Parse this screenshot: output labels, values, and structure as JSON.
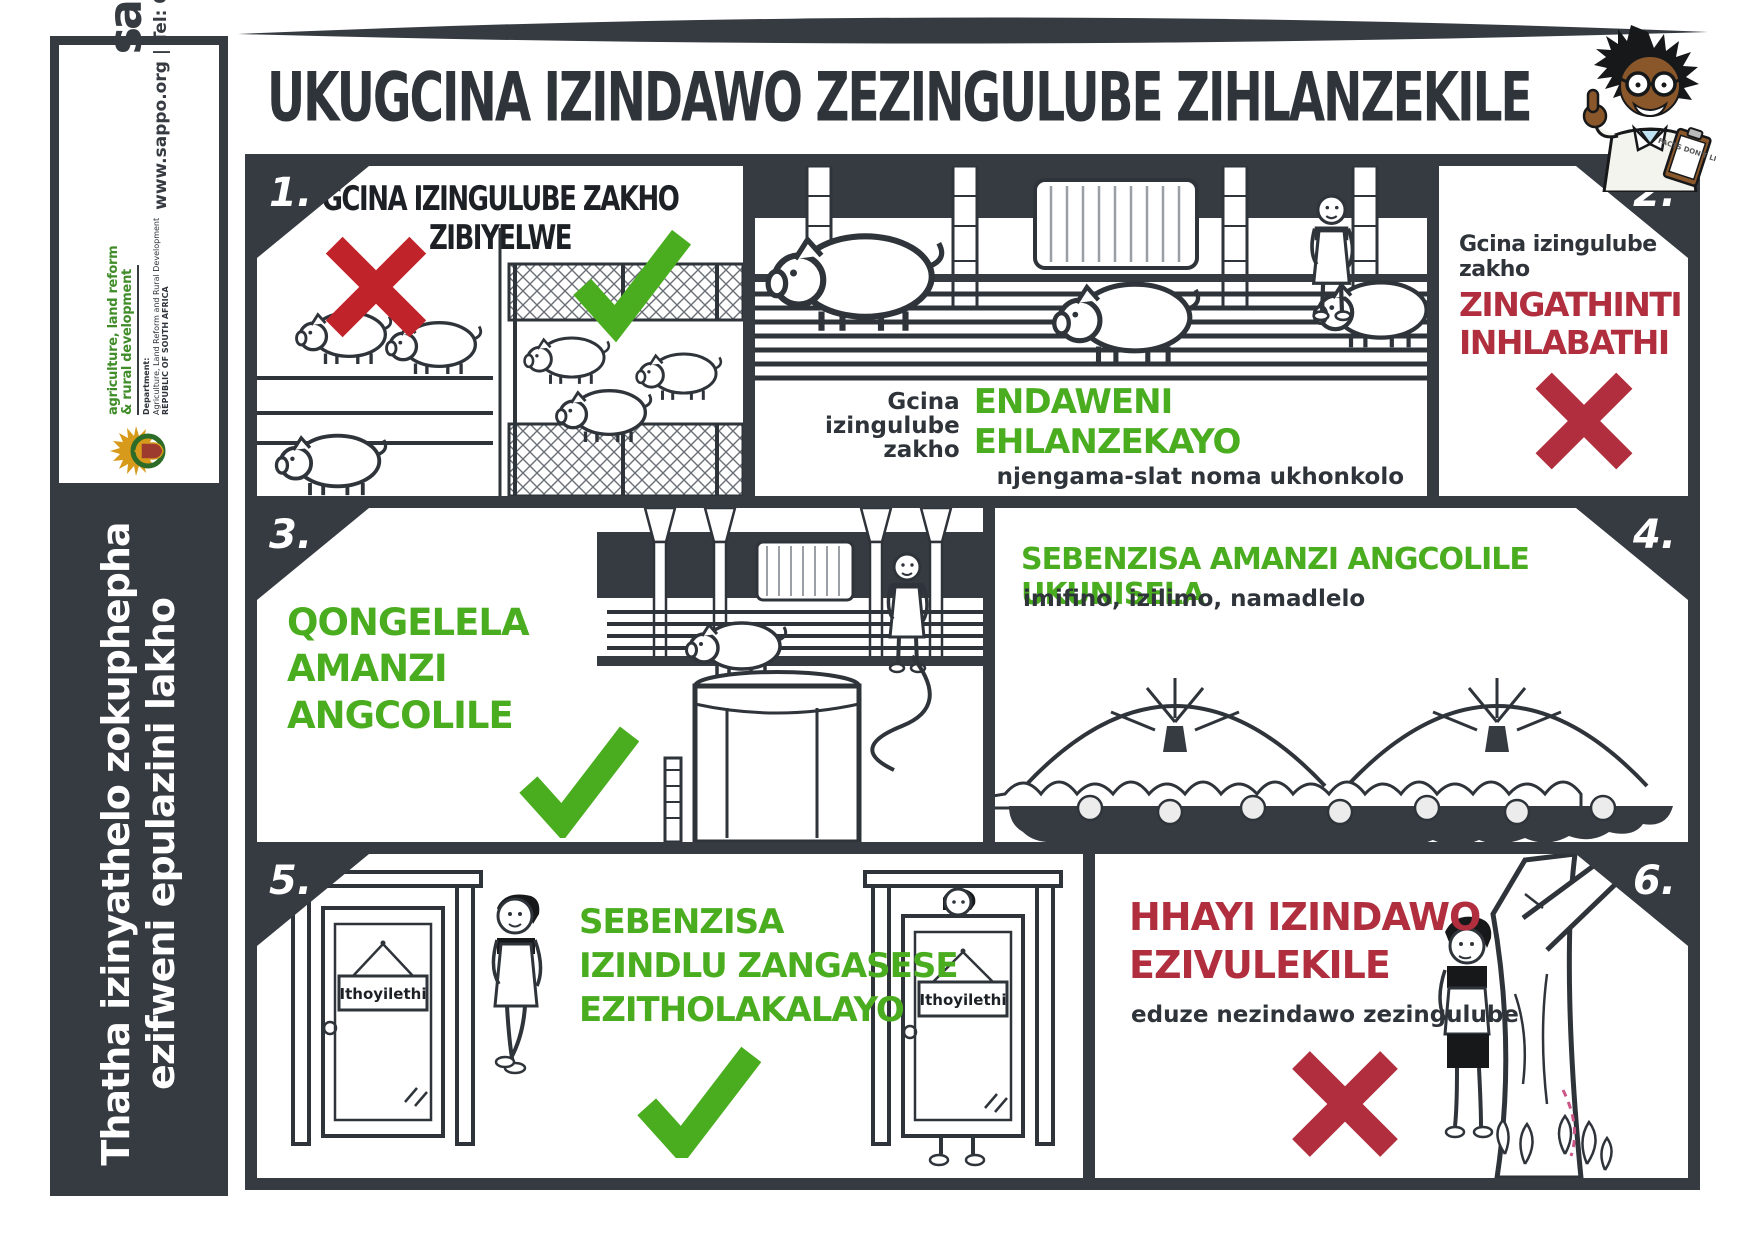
{
  "colors": {
    "charcoal": "#363b42",
    "green": "#4aad1f",
    "bright_red": "#c1232b",
    "crimson": "#b02e3d",
    "dept_green": "#3f8c28"
  },
  "sidebar": {
    "logo_text": "sappo",
    "contact": "www.sappo.org  | Tel: 012 100 3035",
    "dept_heading_line1": "agriculture, land reform",
    "dept_heading_line2": "& rural development",
    "dept_label": "Department:",
    "dept_name": "Agriculture, Land Reform and Rural Development",
    "dept_country": "REPUBLIC OF SOUTH AFRICA",
    "tagline_line1": "Thatha izinyathelo zokuphepha",
    "tagline_line2": "ezifweni epulazini lakho"
  },
  "header": {
    "title": "UKUGCINA IZINDAWO ZEZINGULUBE ZIHLANZEKILE",
    "clipboard_text": "FACTS DON'T LIE"
  },
  "panels": {
    "p1": {
      "number": "1.",
      "heading": "GCINA IZINGULUBE ZAKHO ZIBIYELWE"
    },
    "p2": {
      "number": "2.",
      "caption_prefix_line1": "Gcina izingulube",
      "caption_prefix_line2": "zakho",
      "caption_green": "ENDAWENI EHLANZEKAYO",
      "caption_sub": "njengama-slat noma ukhonkolo",
      "right_prefix": "Gcina izingulube zakho",
      "right_red_line1": "ZINGATHINTI",
      "right_red_line2": "INHLABATHI"
    },
    "p3": {
      "number": "3.",
      "green_line1": "QONGELELA",
      "green_line2": "AMANZI",
      "green_line3": "ANGCOLILE"
    },
    "p4": {
      "number": "4.",
      "green_heading": "SEBENZISA AMANZI ANGCOLILE UKUNISELA",
      "sub": "imifino, izilimo, namadlelo"
    },
    "p5": {
      "number": "5.",
      "green_line1": "SEBENZISA",
      "green_line2": "IZINDLU ZANGASESE",
      "green_line3": "EZITHOLAKALAYO",
      "door_sign": "Ithoyilethi"
    },
    "p6": {
      "number": "6.",
      "red_line1": "HHAYI IZINDAWO",
      "red_line2": "EZIVULEKILE",
      "sub": "eduze nezindawo zezingulube"
    }
  }
}
